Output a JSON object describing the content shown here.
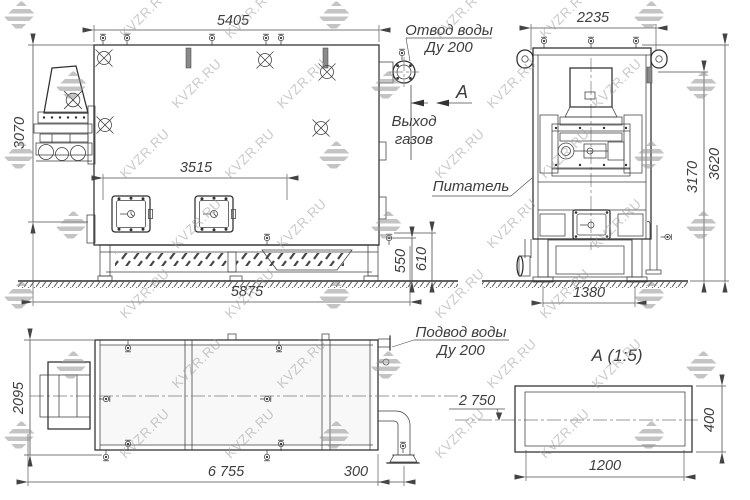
{
  "watermark": {
    "text": "KVZR.RU"
  },
  "colors": {
    "line": "#2f2f2f",
    "dim": "#4d4d4d",
    "watermark": "#9e9e9e",
    "bg": "#ffffff"
  },
  "views": {
    "side": {
      "dims": {
        "top_length": "5405",
        "left_height": "3070",
        "doors_span": "3515",
        "bottom_length": "5875",
        "base_h1": "550",
        "base_h2": "610"
      },
      "labels": {
        "water_outlet1": "Отвод воды",
        "water_outlet2": "Ду 200",
        "section": "А",
        "gas1": "Выход",
        "gas2": "газов"
      }
    },
    "front": {
      "dims": {
        "top_width": "2235",
        "height_inner": "3170",
        "height_outer": "3620",
        "base_width": "1380"
      },
      "labels": {
        "feeder": "Питатель"
      }
    },
    "plan": {
      "dims": {
        "depth": "2095",
        "total_length": "6 755",
        "pipe_offset": "300"
      },
      "labels": {
        "water_inlet1": "Подвод воды",
        "water_inlet2": "Ду 200"
      }
    },
    "detail": {
      "title": "А  (1:5)",
      "dims": {
        "width": "1200",
        "height": "400",
        "level": "2 750"
      }
    }
  }
}
